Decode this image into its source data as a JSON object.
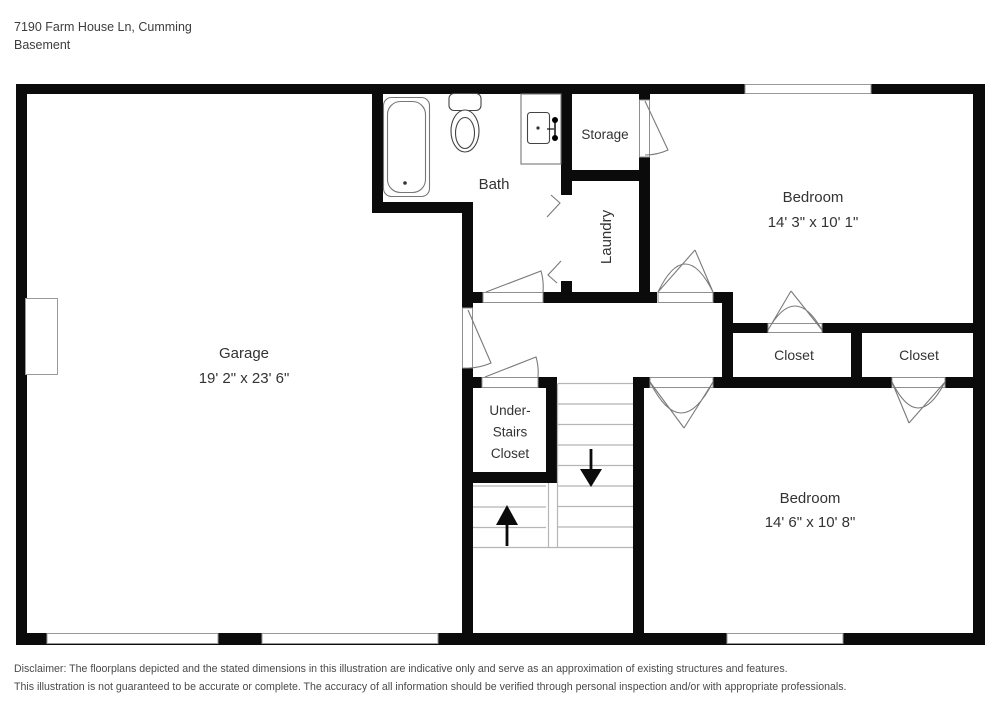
{
  "header": {
    "address": "7190 Farm House Ln, Cumming",
    "floor_label": "Basement"
  },
  "rooms": {
    "garage": {
      "name": "Garage",
      "dims": "19' 2\" x 23' 6\""
    },
    "bath": {
      "name": "Bath"
    },
    "storage": {
      "name": "Storage"
    },
    "laundry": {
      "name": "Laundry"
    },
    "bedroom_top": {
      "name": "Bedroom",
      "dims": "14' 3\" x 10' 1\""
    },
    "bedroom_bottom": {
      "name": "Bedroom",
      "dims": "14' 6\" x 10' 8\""
    },
    "closet_left": {
      "name": "Closet"
    },
    "closet_right": {
      "name": "Closet"
    },
    "understairs": {
      "line1": "Under-",
      "line2": "Stairs",
      "line3": "Closet"
    }
  },
  "disclaimer": {
    "line1": "Disclaimer: The floorplans depicted and the stated dimensions in this illustration are indicative only and serve as an approximation of existing structures and features.",
    "line2": "This illustration is not guaranteed to be accurate or complete. The accuracy of all information should be verified through personal inspection and/or with appropriate professionals."
  },
  "colors": {
    "wall": "#0b0b0b",
    "fixture_stroke": "#777777",
    "stair_stroke": "#b5b5b5",
    "label_text": "#333333",
    "muted_text": "#4a4a4a"
  }
}
